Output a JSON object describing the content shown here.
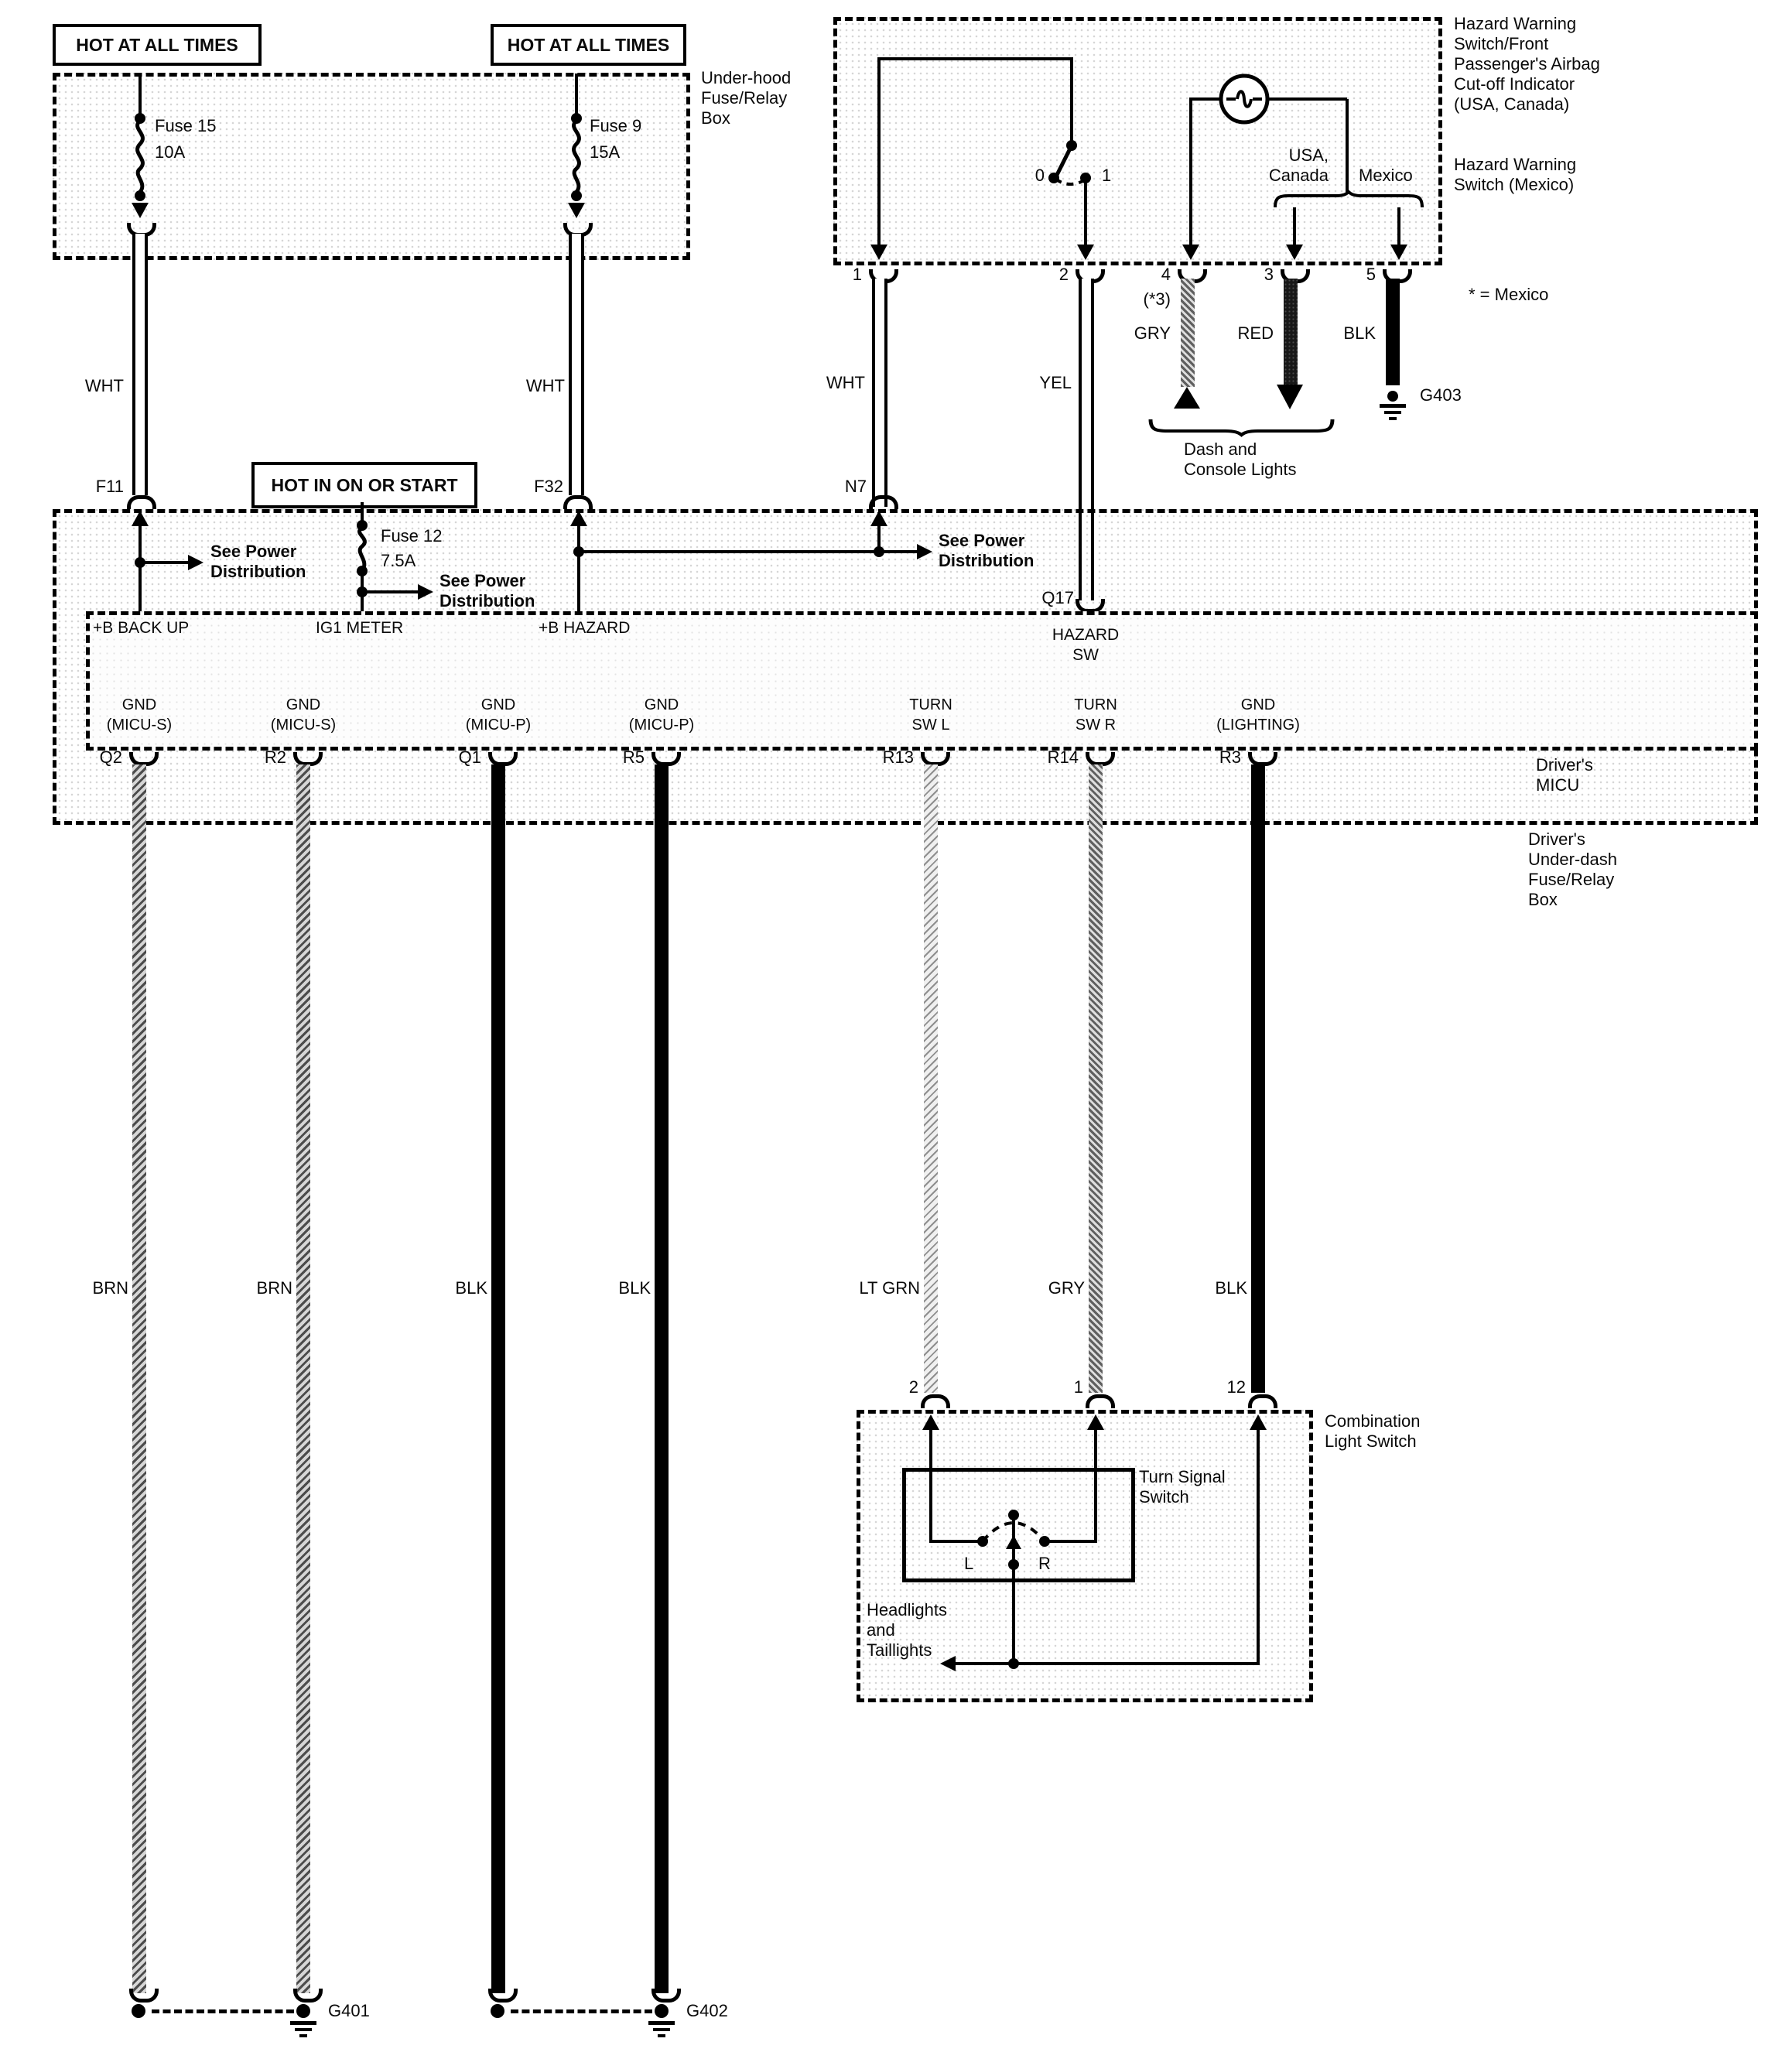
{
  "hot1": "HOT AT ALL TIMES",
  "hot2": "HOT AT ALL TIMES",
  "hot_ign": "HOT IN ON OR START",
  "underhood": {
    "label": [
      "Under-hood",
      "Fuse/Relay",
      "Box"
    ],
    "fuse15": [
      "Fuse 15",
      "10A"
    ],
    "fuse9": [
      "Fuse 9",
      "15A"
    ],
    "f11": "F11",
    "f32": "F32",
    "wht": "WHT"
  },
  "hazard": {
    "right1": [
      "Hazard Warning",
      "Switch/Front",
      "Passenger's Airbag",
      "Cut-off Indicator",
      "(USA, Canada)"
    ],
    "right2": [
      "Hazard Warning",
      "Switch (Mexico)"
    ],
    "sw0": "0",
    "sw1": "1",
    "usa": [
      "USA,",
      "Canada"
    ],
    "mexico": "Mexico",
    "pin1": "1",
    "pin2": "2",
    "pin3": "3",
    "pin4": "4",
    "pin5": "5",
    "note4": "(*3)",
    "gry": "GRY",
    "red": "RED",
    "blk": "BLK",
    "note": "* = Mexico",
    "g403": "G403",
    "brace": [
      "Dash and",
      "Console Lights"
    ],
    "wht": "WHT",
    "yel": "YEL",
    "n7": "N7",
    "q17": "Q17"
  },
  "micu": {
    "see_power": [
      "See Power",
      "Distribution"
    ],
    "fuse12": [
      "Fuse 12",
      "7.5A"
    ],
    "pin_backup": "+B BACK UP",
    "pin_ig1": "IG1 METER",
    "pin_hazard": "+B HAZARD",
    "hazard_sw": [
      "HAZARD",
      "SW"
    ],
    "cols": [
      {
        "id": "Q2",
        "l1": "GND",
        "l2": "(MICU-S)"
      },
      {
        "id": "R2",
        "l1": "GND",
        "l2": "(MICU-S)"
      },
      {
        "id": "Q1",
        "l1": "GND",
        "l2": "(MICU-P)"
      },
      {
        "id": "R5",
        "l1": "GND",
        "l2": "(MICU-P)"
      },
      {
        "id": "R13",
        "l1": "TURN",
        "l2": "SW L"
      },
      {
        "id": "R14",
        "l1": "TURN",
        "l2": "SW R"
      },
      {
        "id": "R3",
        "l1": "GND",
        "l2": "(LIGHTING)"
      }
    ],
    "micu_label": [
      "Driver's",
      "MICU"
    ],
    "box_label": [
      "Driver's",
      "Under-dash",
      "Fuse/Relay",
      "Box"
    ]
  },
  "wires": {
    "w1": "BRN",
    "w2": "BRN",
    "w3": "BLK",
    "w4": "BLK",
    "w5": "LT GRN",
    "w6": "GRY",
    "w7": "BLK"
  },
  "grounds": {
    "g401": "G401",
    "g402": "G402"
  },
  "comb": {
    "pin2": "2",
    "pin1": "1",
    "pin12": "12",
    "label": [
      "Combination",
      "Light Switch"
    ],
    "tss": [
      "Turn Signal",
      "Switch"
    ],
    "l": "L",
    "r": "R",
    "headlights": [
      "Headlights",
      "and",
      "Taillights"
    ]
  }
}
